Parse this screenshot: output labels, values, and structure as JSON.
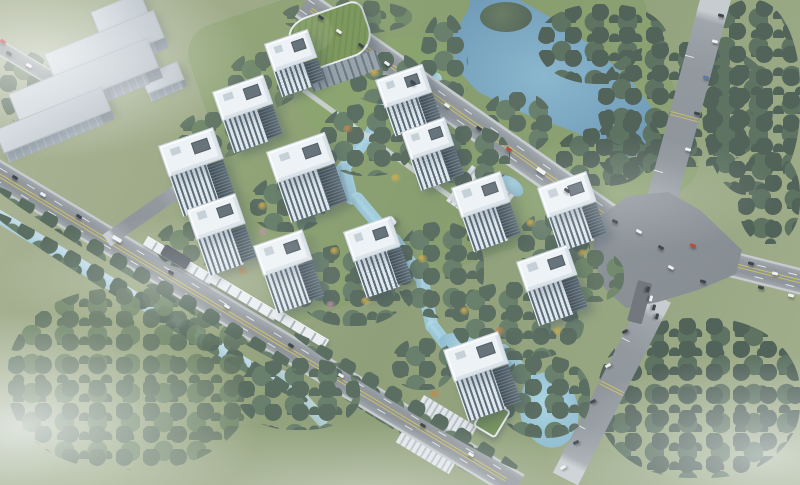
{
  "scene": {
    "type": "aerial-architectural-rendering",
    "subject": "residential-development-masterplan",
    "palette": {
      "grass": "#8f9e74",
      "forest_dark": "#44554a",
      "forest_mid": "#4e6152",
      "autumn_gold": "#cfa93f",
      "autumn_orange": "#c07f3e",
      "blossom_pink": "#b9899a",
      "water_stream": "#9ccbdd",
      "water_river": "#6f9cba",
      "water_canal": "#b6d7e6",
      "asphalt": "#8b9196",
      "lane_yellow": "#d0c054",
      "tower_roof": "#f1f5f7",
      "tower_glass": "#45545e",
      "industrial_roof": "#c3cbd1",
      "podium_green": "#75914f",
      "frame_white": "#ffffff"
    },
    "frame": {
      "top_bar_h": 10,
      "bottom_bar_h": 8
    },
    "towers": [
      {
        "x": 264,
        "y": 44,
        "w": 46,
        "d": 30,
        "f": 26,
        "r": -19
      },
      {
        "x": 212,
        "y": 92,
        "w": 54,
        "d": 31,
        "f": 34,
        "r": -19
      },
      {
        "x": 375,
        "y": 80,
        "w": 50,
        "d": 30,
        "f": 30,
        "r": -19
      },
      {
        "x": 158,
        "y": 146,
        "w": 58,
        "d": 33,
        "f": 42,
        "r": -19
      },
      {
        "x": 266,
        "y": 152,
        "w": 62,
        "d": 33,
        "f": 42,
        "r": -19
      },
      {
        "x": 401,
        "y": 132,
        "w": 46,
        "d": 30,
        "f": 32,
        "r": -19
      },
      {
        "x": 451,
        "y": 188,
        "w": 52,
        "d": 32,
        "f": 36,
        "r": -19
      },
      {
        "x": 537,
        "y": 188,
        "w": 52,
        "d": 32,
        "f": 36,
        "r": -19
      },
      {
        "x": 186,
        "y": 210,
        "w": 52,
        "d": 32,
        "f": 38,
        "r": -19
      },
      {
        "x": 253,
        "y": 246,
        "w": 52,
        "d": 32,
        "f": 40,
        "r": -19
      },
      {
        "x": 343,
        "y": 232,
        "w": 50,
        "d": 32,
        "f": 38,
        "r": -19
      },
      {
        "x": 516,
        "y": 262,
        "w": 54,
        "d": 32,
        "f": 36,
        "r": -19
      },
      {
        "x": 443,
        "y": 350,
        "w": 58,
        "d": 34,
        "f": 42,
        "r": -19
      }
    ],
    "industrial_sheds": [
      {
        "x": 90,
        "y": 12,
        "w": 54,
        "d": 24,
        "f": 8,
        "r": -22
      },
      {
        "x": 44,
        "y": 54,
        "w": 118,
        "d": 30,
        "f": 12,
        "r": -22
      },
      {
        "x": 140,
        "y": 76,
        "w": 40,
        "d": 20,
        "f": 8,
        "r": -22
      },
      {
        "x": 8,
        "y": 94,
        "w": 150,
        "d": 32,
        "f": 12,
        "r": -22
      },
      {
        "x": -6,
        "y": 130,
        "w": 116,
        "d": 26,
        "f": 10,
        "r": -22
      }
    ],
    "groves": [
      {
        "x": 538,
        "y": 4,
        "w": 130,
        "h": 80,
        "c": "dark",
        "z": 3
      },
      {
        "x": 598,
        "y": 42,
        "w": 175,
        "h": 125,
        "c": "dark",
        "z": 3
      },
      {
        "x": 702,
        "y": 0,
        "w": 98,
        "h": 195,
        "c": "dark",
        "z": 3
      },
      {
        "x": 738,
        "y": 152,
        "w": 62,
        "h": 92,
        "c": "dark",
        "z": 3
      },
      {
        "x": 598,
        "y": 318,
        "w": 202,
        "h": 160,
        "c": "dark",
        "z": 3
      },
      {
        "x": 420,
        "y": 14,
        "w": 48,
        "h": 112,
        "c": "mid",
        "z": 3
      },
      {
        "x": 482,
        "y": 92,
        "w": 70,
        "h": 62,
        "c": "mid",
        "z": 3
      },
      {
        "x": 556,
        "y": 128,
        "w": 92,
        "h": 58,
        "c": "dark",
        "z": 3
      },
      {
        "x": 282,
        "y": 0,
        "w": 130,
        "h": 34,
        "c": "sparse",
        "z": 3
      },
      {
        "x": 596,
        "y": 116,
        "w": 66,
        "h": 62,
        "c": "dark",
        "z": 3
      },
      {
        "x": 0,
        "y": 181,
        "w": 360,
        "h": 15,
        "c": "mid",
        "z": 6,
        "r": 31
      },
      {
        "x": 0,
        "y": 206,
        "w": 364,
        "h": 18,
        "c": "mid",
        "z": 3,
        "r": 31
      },
      {
        "x": 298,
        "y": 328,
        "w": 262,
        "h": 14,
        "c": "mid",
        "z": 6,
        "r": 31
      },
      {
        "x": 312,
        "y": 362,
        "w": 232,
        "h": 16,
        "c": "mid",
        "z": 3,
        "r": 31
      },
      {
        "x": 8,
        "y": 288,
        "w": 244,
        "h": 182,
        "c": "sparse",
        "z": 3,
        "o": 0.9
      },
      {
        "x": 0,
        "y": 52,
        "w": 52,
        "h": 72,
        "c": "sparse",
        "z": 3
      },
      {
        "x": 320,
        "y": 104,
        "w": 96,
        "h": 72,
        "c": "mid",
        "z": 5
      },
      {
        "x": 250,
        "y": 176,
        "w": 76,
        "h": 56,
        "c": "mid",
        "z": 5
      },
      {
        "x": 296,
        "y": 244,
        "w": 112,
        "h": 82,
        "c": "mid",
        "z": 5
      },
      {
        "x": 396,
        "y": 222,
        "w": 88,
        "h": 96,
        "c": "mid",
        "z": 5
      },
      {
        "x": 452,
        "y": 282,
        "w": 132,
        "h": 78,
        "c": "mid",
        "z": 5
      },
      {
        "x": 518,
        "y": 212,
        "w": 72,
        "h": 62,
        "c": "mid",
        "z": 5
      },
      {
        "x": 428,
        "y": 126,
        "w": 82,
        "h": 62,
        "c": "mid",
        "z": 5
      },
      {
        "x": 350,
        "y": 52,
        "w": 72,
        "h": 52,
        "c": "mid",
        "z": 5
      },
      {
        "x": 178,
        "y": 112,
        "w": 72,
        "h": 46,
        "c": "sparse",
        "z": 5
      },
      {
        "x": 228,
        "y": 52,
        "w": 72,
        "h": 56,
        "c": "sparse",
        "z": 5
      },
      {
        "x": 156,
        "y": 222,
        "w": 64,
        "h": 46,
        "c": "sparse",
        "z": 5
      },
      {
        "x": 238,
        "y": 358,
        "w": 122,
        "h": 72,
        "c": "mid",
        "z": 5
      },
      {
        "x": 392,
        "y": 338,
        "w": 62,
        "h": 52,
        "c": "mid",
        "z": 5
      },
      {
        "x": 498,
        "y": 356,
        "w": 92,
        "h": 82,
        "c": "mid",
        "z": 5
      },
      {
        "x": 560,
        "y": 250,
        "w": 64,
        "h": 52,
        "c": "sparse",
        "z": 5
      }
    ],
    "accent_trees": [
      [
        236,
        128,
        "g"
      ],
      [
        258,
        202,
        "g"
      ],
      [
        296,
        163,
        "g"
      ],
      [
        330,
        247,
        "g"
      ],
      [
        298,
        295,
        "o"
      ],
      [
        361,
        297,
        "g"
      ],
      [
        391,
        174,
        "g"
      ],
      [
        418,
        255,
        "g"
      ],
      [
        460,
        307,
        "g"
      ],
      [
        495,
        327,
        "o"
      ],
      [
        526,
        219,
        "g"
      ],
      [
        578,
        249,
        "g"
      ],
      [
        343,
        125,
        "o"
      ],
      [
        370,
        69,
        "g"
      ],
      [
        446,
        149,
        "g"
      ],
      [
        238,
        267,
        "o"
      ],
      [
        203,
        237,
        "g"
      ],
      [
        299,
        57,
        "g"
      ],
      [
        553,
        327,
        "g"
      ],
      [
        480,
        372,
        "g"
      ],
      [
        430,
        390,
        "o"
      ],
      [
        296,
        276,
        "p"
      ],
      [
        326,
        301,
        "p"
      ],
      [
        258,
        228,
        "p"
      ]
    ],
    "streams": [
      {
        "x": 437,
        "y": 70,
        "l": 46,
        "r": 56
      },
      {
        "x": 387,
        "y": 86,
        "l": 58,
        "r": 26
      },
      {
        "x": 365,
        "y": 130,
        "l": 52,
        "r": 38
      },
      {
        "x": 336,
        "y": 163,
        "l": 44,
        "r": -14
      },
      {
        "x": 348,
        "y": 198,
        "l": 62,
        "r": -40
      },
      {
        "x": 385,
        "y": 238,
        "l": 58,
        "r": -35
      },
      {
        "x": 415,
        "y": 278,
        "l": 57,
        "r": -12
      },
      {
        "x": 424,
        "y": 326,
        "l": 42,
        "r": -38
      },
      {
        "x": 494,
        "y": 350,
        "l": 52,
        "r": -42
      }
    ],
    "ponds": [
      {
        "x": 438,
        "y": 336,
        "w": 64,
        "h": 26,
        "r": 18
      },
      {
        "x": 520,
        "y": 372,
        "w": 58,
        "h": 76,
        "r": -12
      },
      {
        "x": 497,
        "y": 178,
        "w": 28,
        "h": 16,
        "r": 36
      }
    ],
    "retail_strips": [
      {
        "x": 148,
        "y": 236,
        "w": 78,
        "r": 31
      },
      {
        "x": 212,
        "y": 272,
        "w": 78,
        "r": 31
      },
      {
        "x": 276,
        "y": 308,
        "w": 62,
        "r": 31
      }
    ],
    "plazas": [
      {
        "x": 472,
        "y": 165,
        "w": 52,
        "h": 44,
        "r": 36
      },
      {
        "x": 424,
        "y": 395,
        "w": 62,
        "h": 55,
        "r": 31
      }
    ],
    "cars": [
      [
        318,
        16,
        35,
        "d"
      ],
      [
        336,
        30,
        35,
        "w"
      ],
      [
        358,
        44,
        35,
        "d"
      ],
      [
        384,
        62,
        35,
        "w"
      ],
      [
        410,
        81,
        35,
        "d"
      ],
      [
        444,
        104,
        35,
        "w"
      ],
      [
        476,
        127,
        35,
        "d"
      ],
      [
        506,
        148,
        35,
        "r"
      ],
      [
        536,
        169,
        35,
        "t"
      ],
      [
        564,
        189,
        35,
        "d"
      ],
      [
        718,
        14,
        15,
        "d"
      ],
      [
        712,
        40,
        15,
        "w"
      ],
      [
        703,
        76,
        15,
        "b"
      ],
      [
        694,
        112,
        15,
        "d"
      ],
      [
        685,
        148,
        15,
        "w"
      ],
      [
        612,
        220,
        25,
        "d"
      ],
      [
        636,
        230,
        30,
        "w"
      ],
      [
        658,
        246,
        30,
        "d"
      ],
      [
        690,
        244,
        20,
        "r"
      ],
      [
        668,
        266,
        28,
        "w"
      ],
      [
        700,
        280,
        16,
        "d"
      ],
      [
        748,
        262,
        14,
        "d"
      ],
      [
        772,
        272,
        14,
        "w"
      ],
      [
        758,
        286,
        14,
        "d"
      ],
      [
        788,
        294,
        14,
        "w"
      ],
      [
        622,
        330,
        -27,
        "d"
      ],
      [
        605,
        364,
        -27,
        "w"
      ],
      [
        590,
        400,
        -27,
        "d"
      ],
      [
        573,
        441,
        -27,
        "d"
      ],
      [
        560,
        466,
        -27,
        "w"
      ],
      [
        12,
        176,
        31,
        "d"
      ],
      [
        40,
        193,
        31,
        "w"
      ],
      [
        76,
        215,
        31,
        "d"
      ],
      [
        112,
        237,
        31,
        "t"
      ],
      [
        168,
        271,
        31,
        "d"
      ],
      [
        224,
        305,
        31,
        "w"
      ],
      [
        288,
        344,
        31,
        "d"
      ],
      [
        338,
        374,
        31,
        "w"
      ],
      [
        420,
        424,
        31,
        "d"
      ],
      [
        468,
        453,
        31,
        "w"
      ],
      [
        6,
        52,
        31,
        "d"
      ],
      [
        26,
        64,
        31,
        "w"
      ],
      [
        0,
        40,
        31,
        "r"
      ],
      [
        645,
        288,
        105,
        "d"
      ],
      [
        648,
        297,
        105,
        "w"
      ],
      [
        651,
        306,
        105,
        "d"
      ],
      [
        654,
        315,
        105,
        "d"
      ]
    ],
    "accent_colors": {
      "g": "#cfa93f",
      "o": "#c07f3e",
      "p": "#b9899a"
    }
  }
}
